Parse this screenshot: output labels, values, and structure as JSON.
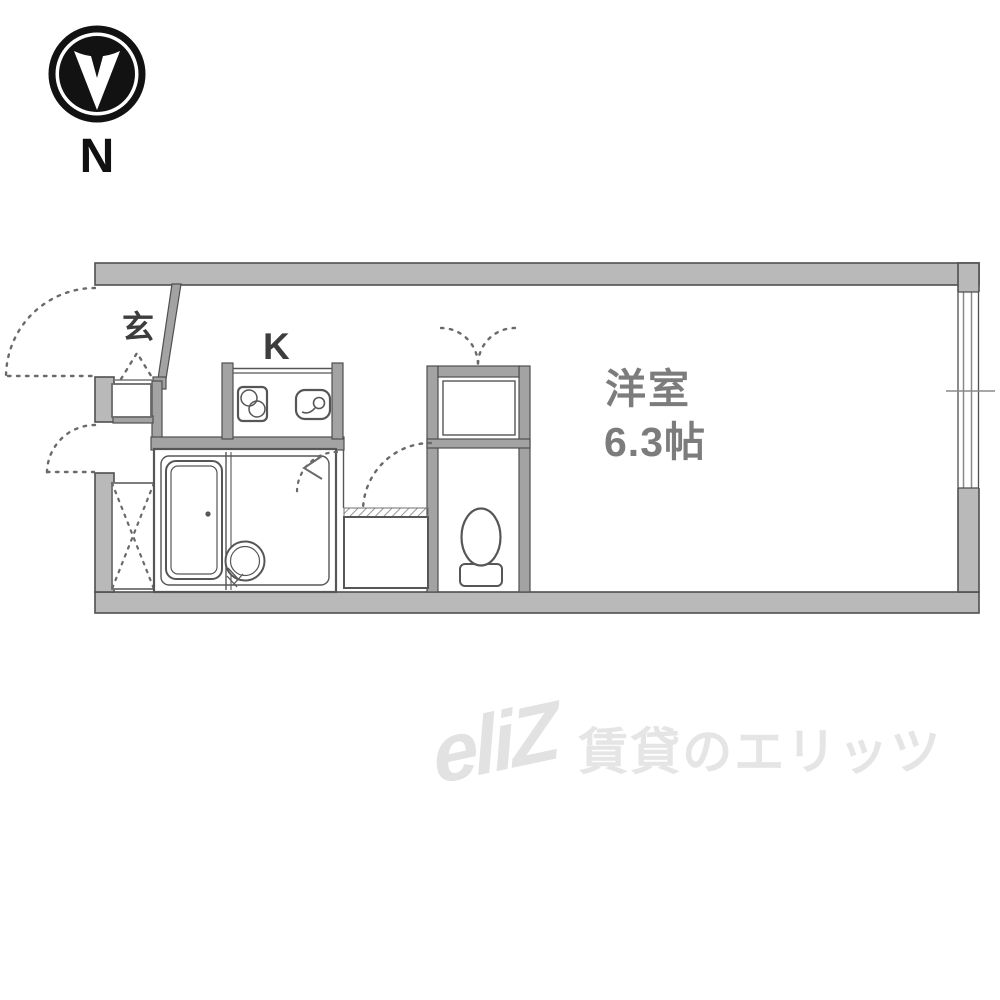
{
  "compass": {
    "north_label": "N"
  },
  "plan": {
    "entrance_label": "玄",
    "kitchen_label": "K",
    "room_label": "洋室",
    "room_size_label": "6.3帖"
  },
  "watermark": {
    "logo": "eliZ",
    "text": "賃貸のエリッツ"
  },
  "colors": {
    "outer_wall_fill": "#b9b9b9",
    "inner_wall_fill": "#a3a3a3",
    "wall_outline": "#4f4f4f",
    "fixture_line": "#565656",
    "dashed_line": "#6a6a6a",
    "room_text": "#7c7c7c",
    "small_label_text": "#3d3d3d",
    "compass": "#121212",
    "watermark_text": "#e4e4e4"
  }
}
